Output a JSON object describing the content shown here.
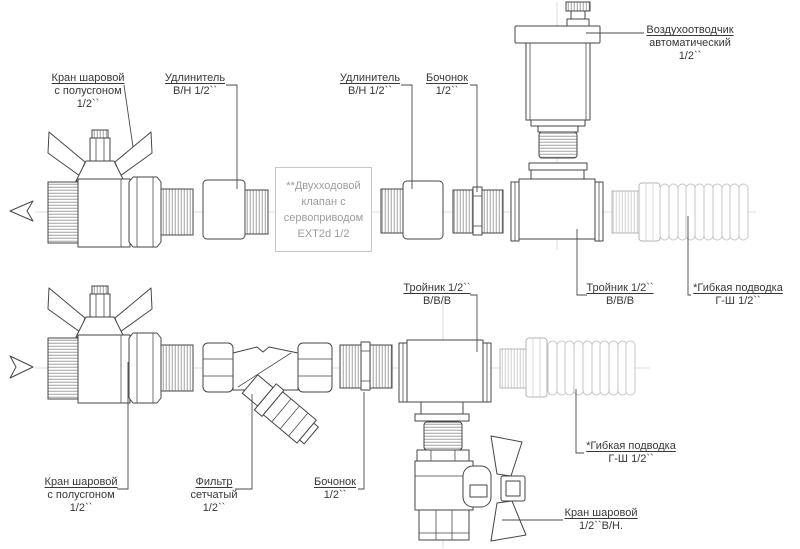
{
  "figure": {
    "type": "plumbing-assembly-diagram",
    "colors": {
      "line": "#454545",
      "light_part": "#c6c6c6",
      "label_text": "#383838",
      "muted_text": "#9c9c9c",
      "centerline": "#dedede"
    }
  },
  "labels": {
    "ball_valve_top": {
      "line1": "Кран шаровой",
      "line2": "с полусгоном",
      "line3": "1/2``"
    },
    "extension_left": {
      "line1": "Удлинитель",
      "line2": "В/Н 1/2``"
    },
    "extension_right": {
      "line1": "Удлинитель",
      "line2": "В/Н 1/2``"
    },
    "barrel_top": {
      "line1": "Бочонок",
      "line2": "1/2``"
    },
    "air_vent": {
      "line1": "Воздухоотводчик",
      "line2": "автоматический",
      "line3": "1/2``"
    },
    "valve_box": {
      "line1": "**Двухходовой",
      "line2": "клапан с",
      "line3": "сервоприводом",
      "line4": "EXT2d 1/2"
    },
    "tee_bottom": {
      "line1": "Тройник 1/2``",
      "line2": "В/В/В"
    },
    "tee_top": {
      "line1": "Тройник 1/2``",
      "line2": "В/В/В"
    },
    "flex_hose_top": {
      "line1": "*Гибкая подводка",
      "line2": "Г-Ш 1/2``"
    },
    "flex_hose_bottom": {
      "line1": "*Гибкая подводка",
      "line2": "Г-Ш 1/2``"
    },
    "ball_valve_bottom": {
      "line1": "Кран шаровой",
      "line2": "с полусгоном",
      "line3": "1/2``"
    },
    "strainer": {
      "line1": "Фильтр",
      "line2": "сетчатый",
      "line3": "1/2``"
    },
    "barrel_bottom": {
      "line1": "Бочонок",
      "line2": "1/2``"
    },
    "ball_valve_vn": {
      "line1": "Кран шаровой",
      "line2": "1/2``В/Н."
    }
  }
}
